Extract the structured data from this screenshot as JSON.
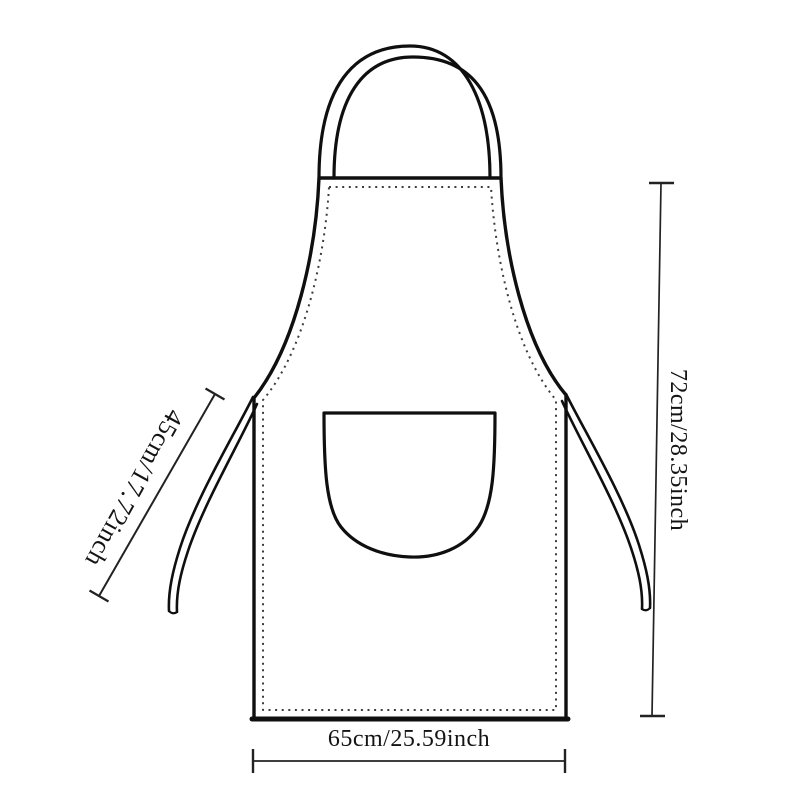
{
  "diagram": {
    "product": "apron",
    "labels": {
      "tie": "45cm/17.72inch",
      "height": "72cm/28.35inch",
      "width": "65cm/25.59inch"
    },
    "colors": {
      "outline": "#0f0f0f",
      "stitch": "#3d3d3d",
      "dimension_line": "#222222",
      "text": "#141414",
      "background": "#ffffff"
    }
  }
}
